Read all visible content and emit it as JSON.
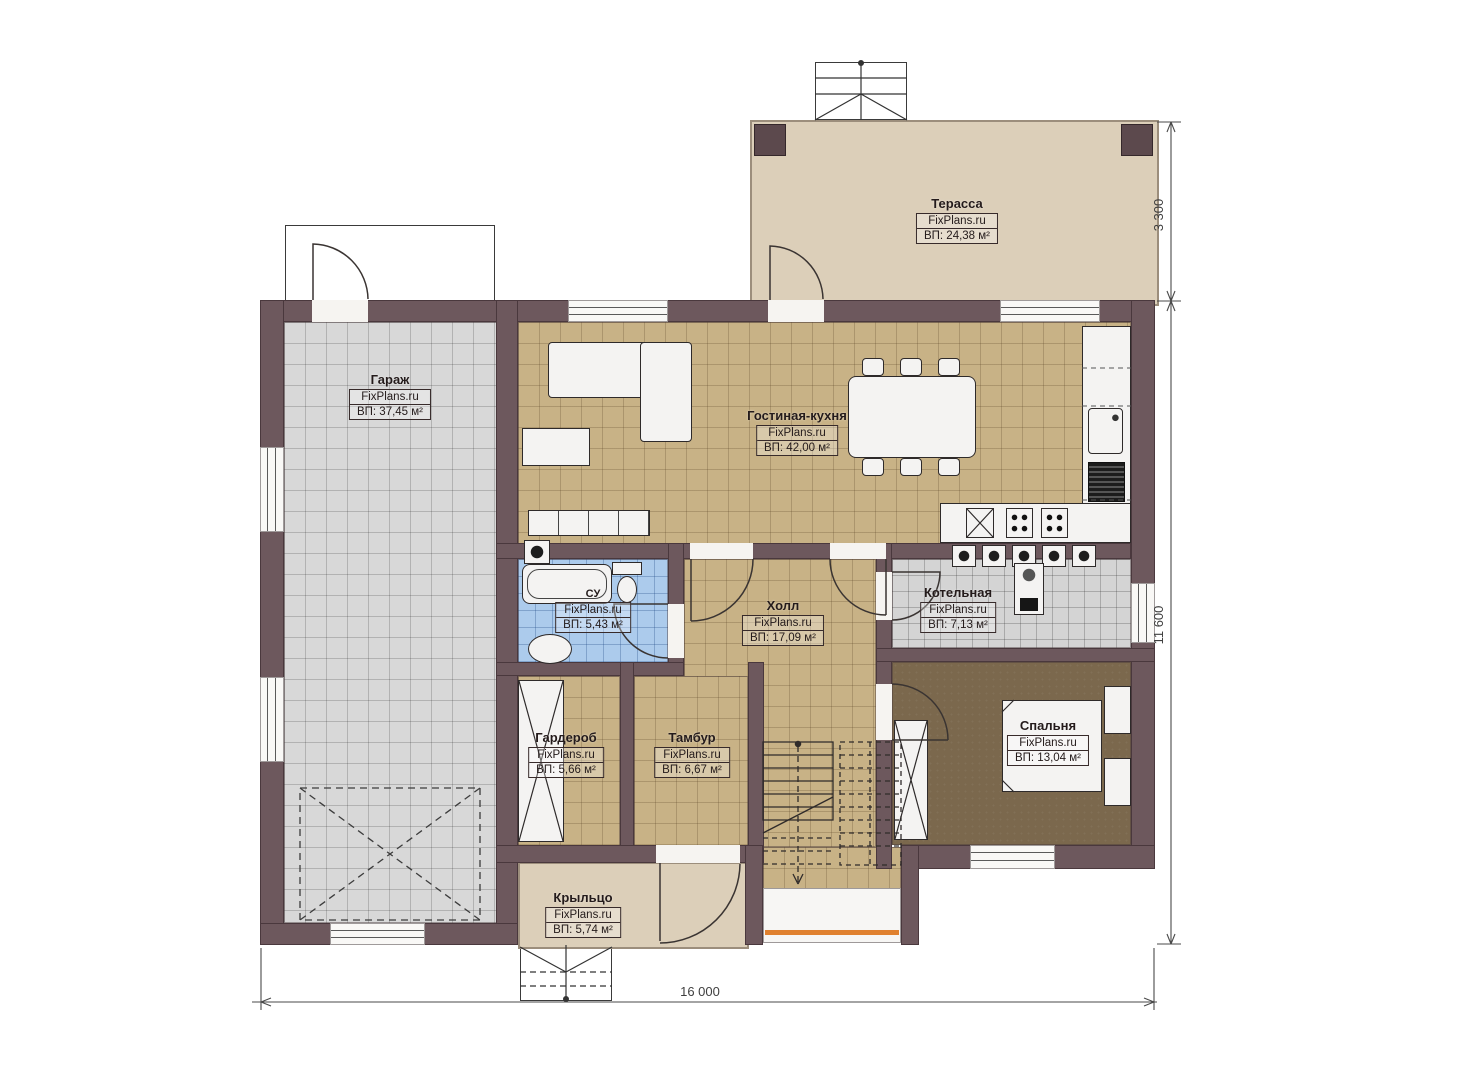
{
  "brand": "FixPlans.ru",
  "rooms": [
    {
      "name": "Терасса",
      "brand": "FixPlans.ru",
      "area": "ВП: 24,38 м²"
    },
    {
      "name": "Гараж",
      "brand": "FixPlans.ru",
      "area": "ВП: 37,45 м²"
    },
    {
      "name": "Гостиная-кухня",
      "brand": "FixPlans.ru",
      "area": "ВП: 42,00 м²"
    },
    {
      "name": "СУ",
      "brand": "FixPlans.ru",
      "area": "ВП: 5,43 м²"
    },
    {
      "name": "Холл",
      "brand": "FixPlans.ru",
      "area": "ВП: 17,09 м²"
    },
    {
      "name": "Котельная",
      "brand": "FixPlans.ru",
      "area": "ВП: 7,13 м²"
    },
    {
      "name": "Гардероб",
      "brand": "FixPlans.ru",
      "area": "ВП: 5,66 м²"
    },
    {
      "name": "Тамбур",
      "brand": "FixPlans.ru",
      "area": "ВП: 6,67 м²"
    },
    {
      "name": "Спальня",
      "brand": "FixPlans.ru",
      "area": "ВП: 13,04 м²"
    },
    {
      "name": "Крыльцо",
      "brand": "FixPlans.ru",
      "area": "ВП: 5,74 м²"
    }
  ],
  "dimensions": {
    "terrace_depth": "3 300",
    "house_depth": "11 600",
    "house_width": "16 000"
  },
  "colors": {
    "wall": "#6d585d",
    "floor_tan": "#c8b286",
    "floor_garage": "#d8d8d8",
    "floor_bath": "#accbec",
    "floor_boiler": "#d4d4d4",
    "floor_terrace": "#dccfb9",
    "floor_bedroom": "#7b684d",
    "accent_orange": "#e0812f"
  }
}
